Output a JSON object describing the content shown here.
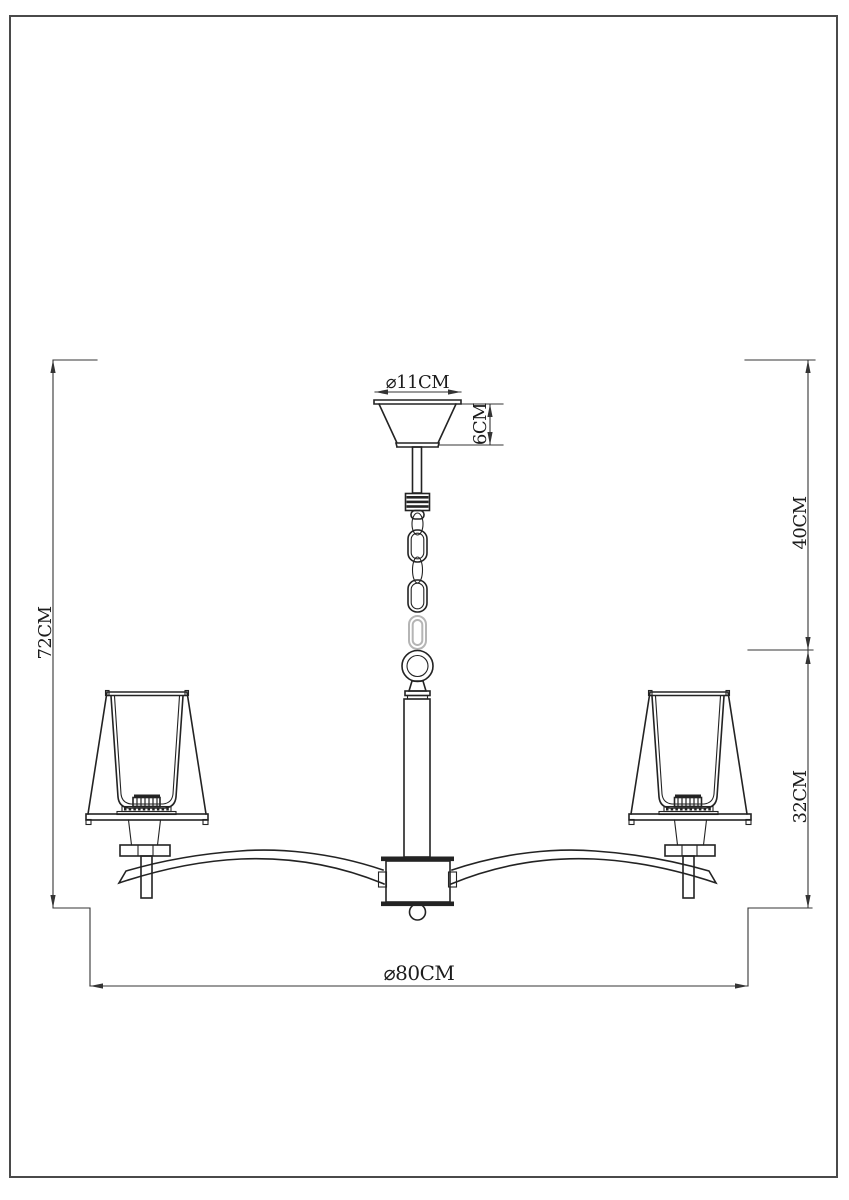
{
  "dimensions": {
    "canopy_diameter_label": "⌀11CM",
    "canopy_height_label": "6CM",
    "suspension_length_label": "40CM",
    "overall_height_label": "72CM",
    "body_height_label": "32CM",
    "overall_diameter_label": "⌀80CM"
  },
  "colors": {
    "line": "#232323",
    "dim_line": "#343434",
    "faint_link": "#b5b5b5",
    "text": "#1c1c1c",
    "page_border": "#4a4a4a",
    "background": "#ffffff"
  }
}
